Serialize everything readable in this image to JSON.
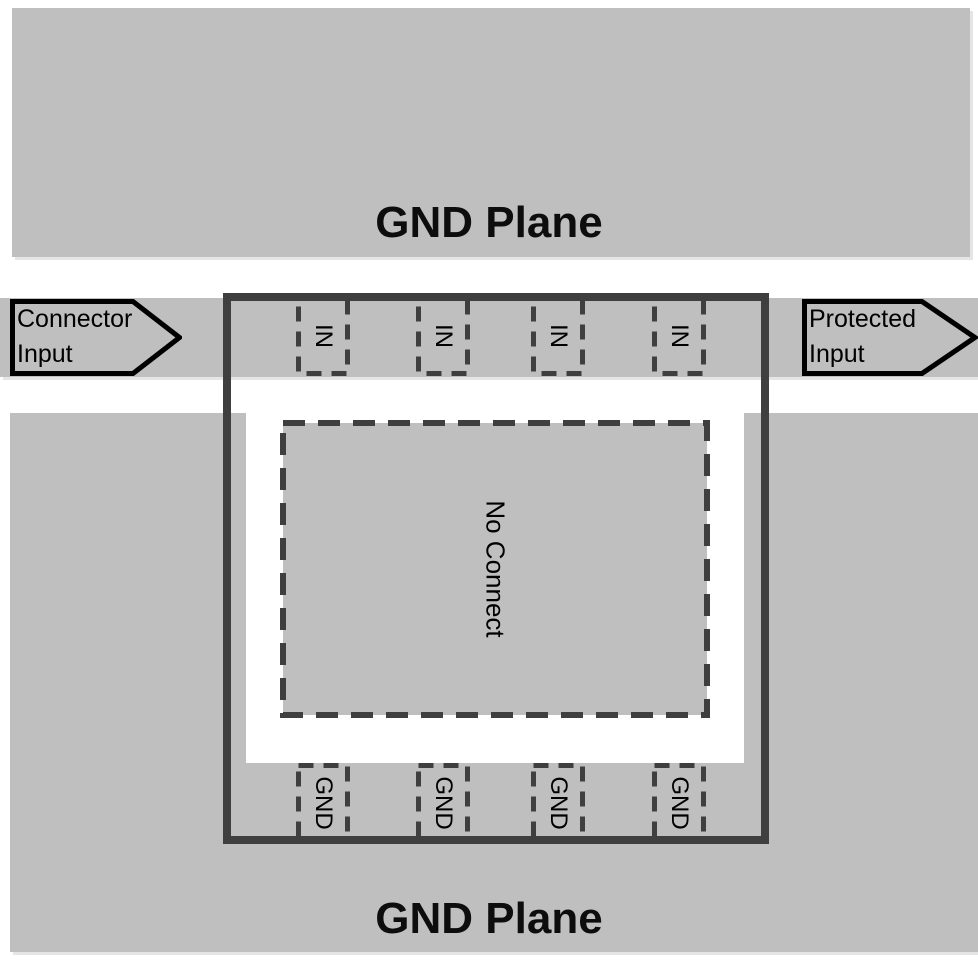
{
  "diagram": {
    "title_hint": "PCB layout diagram: protection device between connector input and protected input over GND planes",
    "planes": {
      "top_label": "GND Plane",
      "bottom_label": "GND Plane"
    },
    "arrows": {
      "left": {
        "lines": [
          "Connector",
          "Input"
        ]
      },
      "right": {
        "lines": [
          "Protected",
          "Input"
        ]
      }
    },
    "chip": {
      "no_connect_label": "No Connect",
      "in_pins": [
        {
          "label": "IN"
        },
        {
          "label": "IN"
        },
        {
          "label": "IN"
        },
        {
          "label": "IN"
        }
      ],
      "gnd_pins": [
        {
          "label": "GND"
        },
        {
          "label": "GND"
        },
        {
          "label": "GND"
        },
        {
          "label": "GND"
        }
      ]
    },
    "colors": {
      "copper_gray": "#bfbfbf",
      "outline_dark_gray": "#3f3f3f",
      "arrow_stroke": "#000000",
      "text": "#000000",
      "background": "#ffffff"
    }
  }
}
